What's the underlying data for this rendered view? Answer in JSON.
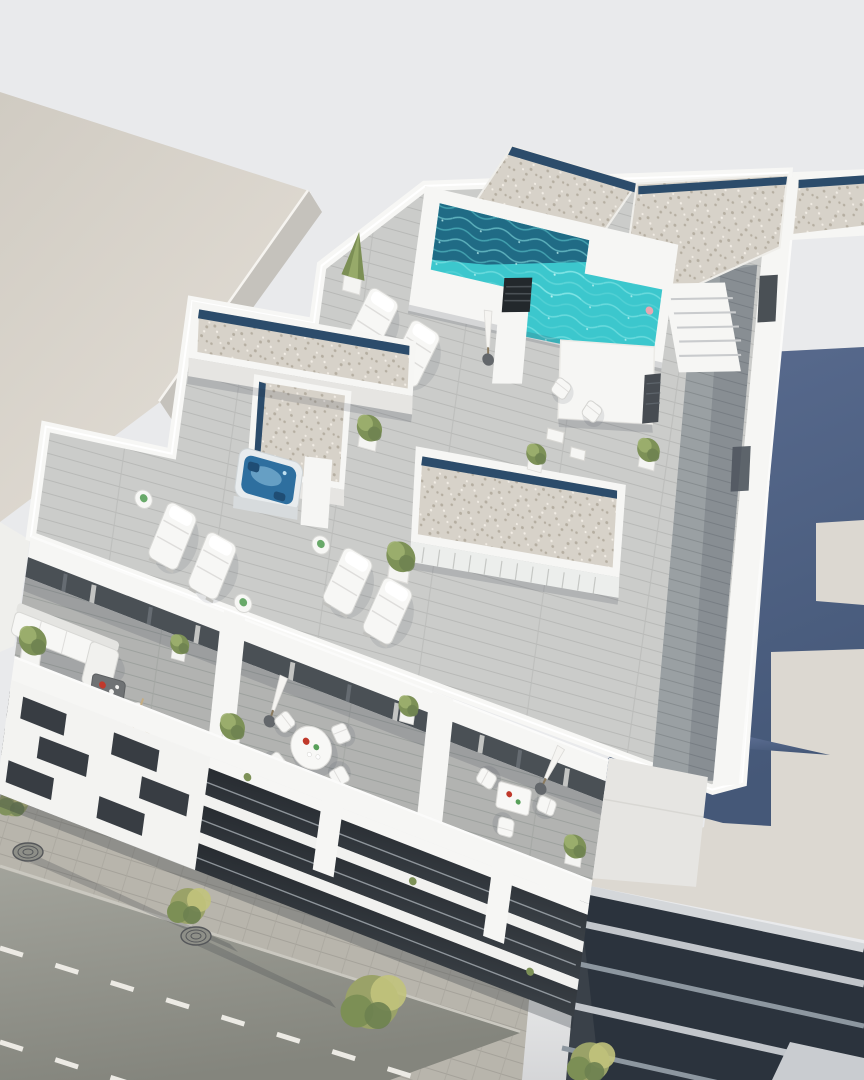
{
  "meta": {
    "type": "architectural-3d-render",
    "view": "aerial top-down oblique",
    "subject": "modern white apartment building rooftop with swimming pool, wood-deck terraces, hot tub and balconies, street at lower left, neighbouring buildings at top-left and bottom-right"
  },
  "palette": {
    "bg": "#e9eaec",
    "neighbor_roof": "#d6d1c8",
    "neighbor_roof_light": "#e4dfd7",
    "neighbor_roof_edge": "#f6f4f0",
    "neighbor_wall_edge": "#c5c2bc",
    "white": "#f6f6f4",
    "white_shade": "#e6e5e2",
    "white_dark": "#d0cfcc",
    "gravel": "#d7d2c9",
    "gravel_dot": "#b5aea1",
    "gravel_dot_light": "#f1ece4",
    "skylight_strip": "#2c4c6b",
    "pool_water": "#3cc7cd",
    "pool_deep": "#1e637f",
    "pool_ripple": "#8feaea",
    "pool_float_pink": "#e8a7b2",
    "deck_light": "#cbccca",
    "deck_light_line": "#b8b9b7",
    "deck_mid": "#b2b3b1",
    "deck_mid_line": "#9da19e",
    "deck_dark": "#9aa0a3",
    "deck_dark_line": "#868c8f",
    "glass_dark": "#4a5055",
    "curtain_light": "#d9d9d6",
    "hot_tub_water": "#2e6f9f",
    "hot_tub_light": "#7fb3d4",
    "hot_tub_rim": "#e8ecee",
    "shadow_wall_top": "#5a6c90",
    "shadow_wall_bottom": "#455878",
    "sun_wall": "#dcd8d1",
    "sun_wall_dim": "#cfccc5",
    "louver_dark": "#2b333d",
    "louver_slab": "#c2c6cb",
    "louver_slab_dim": "#8d97a0",
    "street": "#9da098",
    "street_dark": "#878a82",
    "lane_marking": "#eceae4",
    "sidewalk": "#b8b5ac",
    "paver_line": "#a5a29a",
    "curb": "#cac8c0",
    "tree_olive": "#9aa268",
    "tree_green": "#7c8f55",
    "tree_yellow": "#c2c37c",
    "shrub_green": "#7d9157",
    "shrub_light": "#9db06f",
    "furniture_white": "#f7f7f5",
    "furniture_shadow": "#d8d8d5",
    "furniture_frame": "#bfbfbc",
    "wood_chair": "#c4ad83",
    "accent_red": "#c0392b",
    "accent_green": "#58a05a",
    "umbrella_base": "#63676b",
    "chimney_dark": "#23282c",
    "facade_recess": "#2e3338",
    "window_dark": "#383d43",
    "alley_dark": "#3a4149",
    "shadow_soft": "rgba(44,52,70,0.16)"
  },
  "scene": {
    "neighbor_building_left": {
      "label": "adjacent building flat beige roof",
      "position": "top-left"
    },
    "street": {
      "position": "bottom-left",
      "lane_markings": "white dashed",
      "trees": 4,
      "tree_grates": 2,
      "sidewalk": "stone pavers"
    },
    "main_building": {
      "rooftop": {
        "pool": {
          "shape": "L",
          "water": "turquoise",
          "float": "pink"
        },
        "gravel_roofs": 4,
        "skylight_strips": "dark blue",
        "hot_tub": 1,
        "chimney": 1,
        "sun_loungers": 6,
        "deck_chairs": 2,
        "parasols_closed": 1,
        "stairs": 1,
        "shrubs_potted": 5,
        "cone_tree": 1,
        "louvered_block": 1
      },
      "penthouse": {
        "terraces": 3,
        "sofa_set": 1,
        "round_dining_table": 1,
        "square_dining_table": 1,
        "parasols_closed": 2,
        "chairs": 8,
        "table_accents": [
          "red",
          "green"
        ]
      },
      "facade": {
        "floors": 3,
        "style": "white slabs, recessed balconies, staggered dark windows"
      }
    },
    "neighbor_building_right": {
      "position": "bottom-right",
      "cast_shadow_of_main_building": true,
      "parasol_shadow_spike": true,
      "louver_facade": "dark horizontal bands with light slab edges"
    }
  }
}
